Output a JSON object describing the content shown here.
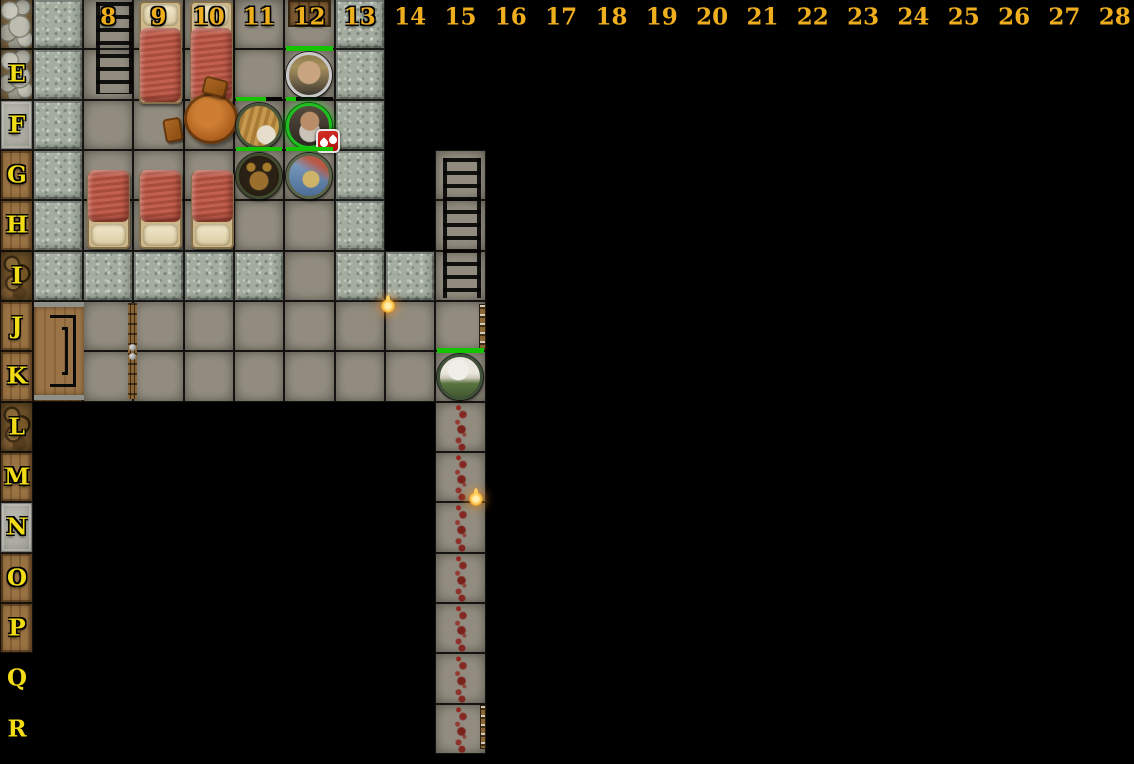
{
  "scene": {
    "type": "virtual-tabletop-dungeon-map",
    "background": "#000000",
    "width": 1134,
    "height": 764
  },
  "grid": {
    "cell_size": 50.33,
    "origin_x": 83,
    "first_col": 8,
    "top_offset": -1,
    "rows_all": [
      "D",
      "E",
      "F",
      "G",
      "H",
      "I",
      "J",
      "K",
      "L",
      "M",
      "N",
      "O",
      "P",
      "Q",
      "R"
    ],
    "column_labels": [
      "8",
      "9",
      "10",
      "11",
      "12",
      "13",
      "14",
      "15",
      "16",
      "17",
      "18",
      "19",
      "20",
      "21",
      "22",
      "23",
      "24",
      "25",
      "26",
      "27",
      "28"
    ],
    "row_labels": [
      "E",
      "F",
      "G",
      "H",
      "I",
      "J",
      "K",
      "L",
      "M",
      "N",
      "O",
      "P",
      "Q",
      "R"
    ],
    "column_label_color": "#efae1e",
    "row_label_color": "#f2dc15",
    "column_label_y": 17,
    "row_label_x": 17
  },
  "palette": {
    "floor": "#8b8679",
    "stone_wall": "#a3ac9f",
    "wood": "#9a7343",
    "slab": "#b4b4aa",
    "hp_green": "#14c400",
    "badge_red": "#c41414",
    "selected_ring_green": "#1fbf1f",
    "blood": "#8e1710",
    "torch_flame": "#ffc040",
    "label_gold": "#efae1e"
  },
  "tiles": [
    {
      "t": "stone",
      "c": 7,
      "r": "D"
    },
    {
      "t": "stone",
      "c": 7,
      "r": "E"
    },
    {
      "t": "stone",
      "c": 7,
      "r": "F"
    },
    {
      "t": "stone",
      "c": 7,
      "r": "G"
    },
    {
      "t": "stone",
      "c": 7,
      "r": "H"
    },
    {
      "t": "stone",
      "c": 7,
      "r": "I"
    },
    {
      "t": "stone",
      "c": 13,
      "r": "D"
    },
    {
      "t": "stone",
      "c": 13,
      "r": "E"
    },
    {
      "t": "stone",
      "c": 13,
      "r": "F"
    },
    {
      "t": "stone",
      "c": 13,
      "r": "G"
    },
    {
      "t": "stone",
      "c": 13,
      "r": "H"
    },
    {
      "t": "stone",
      "c": 13,
      "r": "I"
    },
    {
      "t": "stone",
      "c": 8,
      "r": "I"
    },
    {
      "t": "stone",
      "c": 9,
      "r": "I"
    },
    {
      "t": "stone",
      "c": 10,
      "r": "I"
    },
    {
      "t": "stone",
      "c": 11,
      "r": "I"
    },
    {
      "t": "stone",
      "c": 14,
      "r": "I"
    },
    {
      "t": "floor",
      "c": 8,
      "r": "D"
    },
    {
      "t": "floor",
      "c": 9,
      "r": "D"
    },
    {
      "t": "floor",
      "c": 10,
      "r": "D"
    },
    {
      "t": "floor",
      "c": 11,
      "r": "D"
    },
    {
      "t": "floor",
      "c": 12,
      "r": "D"
    },
    {
      "t": "floor",
      "c": 8,
      "r": "E"
    },
    {
      "t": "floor",
      "c": 9,
      "r": "E"
    },
    {
      "t": "floor",
      "c": 10,
      "r": "E"
    },
    {
      "t": "floor",
      "c": 11,
      "r": "E"
    },
    {
      "t": "floor",
      "c": 12,
      "r": "E"
    },
    {
      "t": "floor",
      "c": 8,
      "r": "F"
    },
    {
      "t": "floor",
      "c": 9,
      "r": "F"
    },
    {
      "t": "floor",
      "c": 10,
      "r": "F"
    },
    {
      "t": "floor",
      "c": 11,
      "r": "F"
    },
    {
      "t": "floor",
      "c": 12,
      "r": "F"
    },
    {
      "t": "floor",
      "c": 8,
      "r": "G"
    },
    {
      "t": "floor",
      "c": 9,
      "r": "G"
    },
    {
      "t": "floor",
      "c": 10,
      "r": "G"
    },
    {
      "t": "floor",
      "c": 11,
      "r": "G"
    },
    {
      "t": "floor",
      "c": 12,
      "r": "G"
    },
    {
      "t": "floor",
      "c": 8,
      "r": "H"
    },
    {
      "t": "floor",
      "c": 9,
      "r": "H"
    },
    {
      "t": "floor",
      "c": 10,
      "r": "H"
    },
    {
      "t": "floor",
      "c": 11,
      "r": "H"
    },
    {
      "t": "floor",
      "c": 12,
      "r": "H"
    },
    {
      "t": "floor",
      "c": 12,
      "r": "I"
    },
    {
      "t": "floor",
      "c": 8,
      "r": "J"
    },
    {
      "t": "floor",
      "c": 9,
      "r": "J"
    },
    {
      "t": "floor",
      "c": 10,
      "r": "J"
    },
    {
      "t": "floor",
      "c": 11,
      "r": "J"
    },
    {
      "t": "floor",
      "c": 12,
      "r": "J"
    },
    {
      "t": "floor",
      "c": 13,
      "r": "J"
    },
    {
      "t": "floor",
      "c": 14,
      "r": "J"
    },
    {
      "t": "floor",
      "c": 15,
      "r": "J"
    },
    {
      "t": "floor",
      "c": 8,
      "r": "K"
    },
    {
      "t": "floor",
      "c": 9,
      "r": "K"
    },
    {
      "t": "floor",
      "c": 10,
      "r": "K"
    },
    {
      "t": "floor",
      "c": 11,
      "r": "K"
    },
    {
      "t": "floor",
      "c": 12,
      "r": "K"
    },
    {
      "t": "floor",
      "c": 13,
      "r": "K"
    },
    {
      "t": "floor",
      "c": 14,
      "r": "K"
    },
    {
      "t": "floor",
      "c": 15,
      "r": "K"
    },
    {
      "t": "floor",
      "c": 15,
      "r": "G"
    },
    {
      "t": "floor",
      "c": 15,
      "r": "H"
    },
    {
      "t": "floor",
      "c": 15,
      "r": "I"
    },
    {
      "t": "floor",
      "c": 15,
      "r": "L",
      "blood": true
    },
    {
      "t": "floor",
      "c": 15,
      "r": "M",
      "blood": true
    },
    {
      "t": "floor",
      "c": 15,
      "r": "N",
      "blood": true
    },
    {
      "t": "floor",
      "c": 15,
      "r": "O",
      "blood": true
    },
    {
      "t": "floor",
      "c": 15,
      "r": "P",
      "blood": true
    },
    {
      "t": "floor",
      "c": 15,
      "r": "Q",
      "blood": true
    },
    {
      "t": "floor",
      "c": 15,
      "r": "R",
      "blood": true
    },
    {
      "t": "wood",
      "c": 7,
      "r": "J"
    },
    {
      "t": "wood",
      "c": 7,
      "r": "K"
    },
    {
      "t": "rocks",
      "x": 0,
      "w": 33,
      "r": "D"
    },
    {
      "t": "rocks",
      "x": 0,
      "w": 33,
      "r": "E"
    },
    {
      "t": "slab",
      "x": 0,
      "w": 33,
      "r": "F"
    },
    {
      "t": "wood",
      "x": 0,
      "w": 33,
      "r": "G"
    },
    {
      "t": "wood",
      "x": 0,
      "w": 33,
      "r": "H"
    },
    {
      "t": "debris",
      "x": 0,
      "w": 33,
      "r": "I"
    },
    {
      "t": "wood",
      "x": 0,
      "w": 33,
      "r": "J"
    },
    {
      "t": "wood",
      "x": 0,
      "w": 33,
      "r": "K"
    },
    {
      "t": "debris",
      "x": 0,
      "w": 33,
      "r": "L"
    },
    {
      "t": "wood",
      "x": 0,
      "w": 33,
      "r": "M"
    },
    {
      "t": "slab",
      "x": 0,
      "w": 33,
      "r": "N"
    },
    {
      "t": "wood",
      "x": 0,
      "w": 33,
      "r": "O"
    },
    {
      "t": "wood",
      "x": 0,
      "w": 33,
      "r": "P"
    }
  ],
  "furniture": [
    {
      "kind": "ladder",
      "x": 96,
      "y": 2,
      "w": 37,
      "h": 92
    },
    {
      "kind": "ladder",
      "x": 443,
      "y": 158,
      "w": 38,
      "h": 140
    },
    {
      "kind": "bed",
      "variant": "top",
      "x": 139,
      "y": 1,
      "w": 43,
      "h": 103
    },
    {
      "kind": "bed",
      "variant": "top",
      "x": 190,
      "y": 1,
      "w": 43,
      "h": 103
    },
    {
      "kind": "bed",
      "variant": "bottom",
      "x": 87,
      "y": 171,
      "w": 43,
      "h": 78
    },
    {
      "kind": "bed",
      "variant": "bottom",
      "x": 139,
      "y": 171,
      "w": 43,
      "h": 78
    },
    {
      "kind": "bed",
      "variant": "bottom",
      "x": 191,
      "y": 171,
      "w": 43,
      "h": 78
    },
    {
      "kind": "table",
      "x": 184,
      "y": 93,
      "w": 54,
      "h": 51
    },
    {
      "kind": "stool",
      "x": 203,
      "y": 78,
      "w": 24,
      "h": 18,
      "rot": 14
    },
    {
      "kind": "stool",
      "x": 164,
      "y": 118,
      "w": 18,
      "h": 24,
      "rot": -10
    },
    {
      "kind": "stairs",
      "x": 34,
      "y": 302,
      "w": 50,
      "h": 98
    },
    {
      "kind": "door-top",
      "x": 288,
      "y": 0,
      "w": 43,
      "h": 27
    },
    {
      "kind": "door-divider",
      "x": 128,
      "y": 303,
      "w": 9,
      "h": 96
    },
    {
      "kind": "door-edge",
      "x": 479,
      "y": 304,
      "w": 7,
      "h": 45
    },
    {
      "kind": "door-edge",
      "x": 480,
      "y": 705,
      "w": 6,
      "h": 44
    },
    {
      "kind": "torch",
      "x": 381,
      "y": 299,
      "w": 14,
      "h": 14
    },
    {
      "kind": "torch",
      "x": 469,
      "y": 492,
      "w": 14,
      "h": 14
    }
  ],
  "tokens": [
    {
      "id": "e12",
      "description": "long-haired blond man portrait",
      "c": 12,
      "r": "E",
      "hp": 1.0,
      "ring": "#c9c9c9",
      "art": "blond",
      "selected": false,
      "badge": null
    },
    {
      "id": "f11",
      "description": "tawny furred beast",
      "c": 11,
      "r": "F",
      "hp": 0.65,
      "ring": "#49563b",
      "art": "beast",
      "selected": false,
      "badge": null
    },
    {
      "id": "f12",
      "description": "grey-bearded man portrait",
      "c": 12,
      "r": "F",
      "hp": 0.2,
      "ring": "#1fbf1f",
      "art": "greybeard",
      "selected": true,
      "badge": "blood-drops"
    },
    {
      "id": "g11",
      "description": "horned-helmet warrior",
      "c": 11,
      "r": "G",
      "hp": 1.0,
      "ring": "#41492f",
      "art": "horned",
      "selected": false,
      "badge": null
    },
    {
      "id": "g12",
      "description": "figure with banner on blue sky",
      "c": 12,
      "r": "G",
      "hp": 1.0,
      "ring": "#5a6549",
      "art": "banner",
      "selected": false,
      "badge": null
    },
    {
      "id": "k15",
      "description": "white-haired elf woman in green",
      "c": 15,
      "r": "K",
      "hp": 1.0,
      "ring": "#3f5138",
      "art": "elf",
      "selected": false,
      "badge": null
    }
  ]
}
